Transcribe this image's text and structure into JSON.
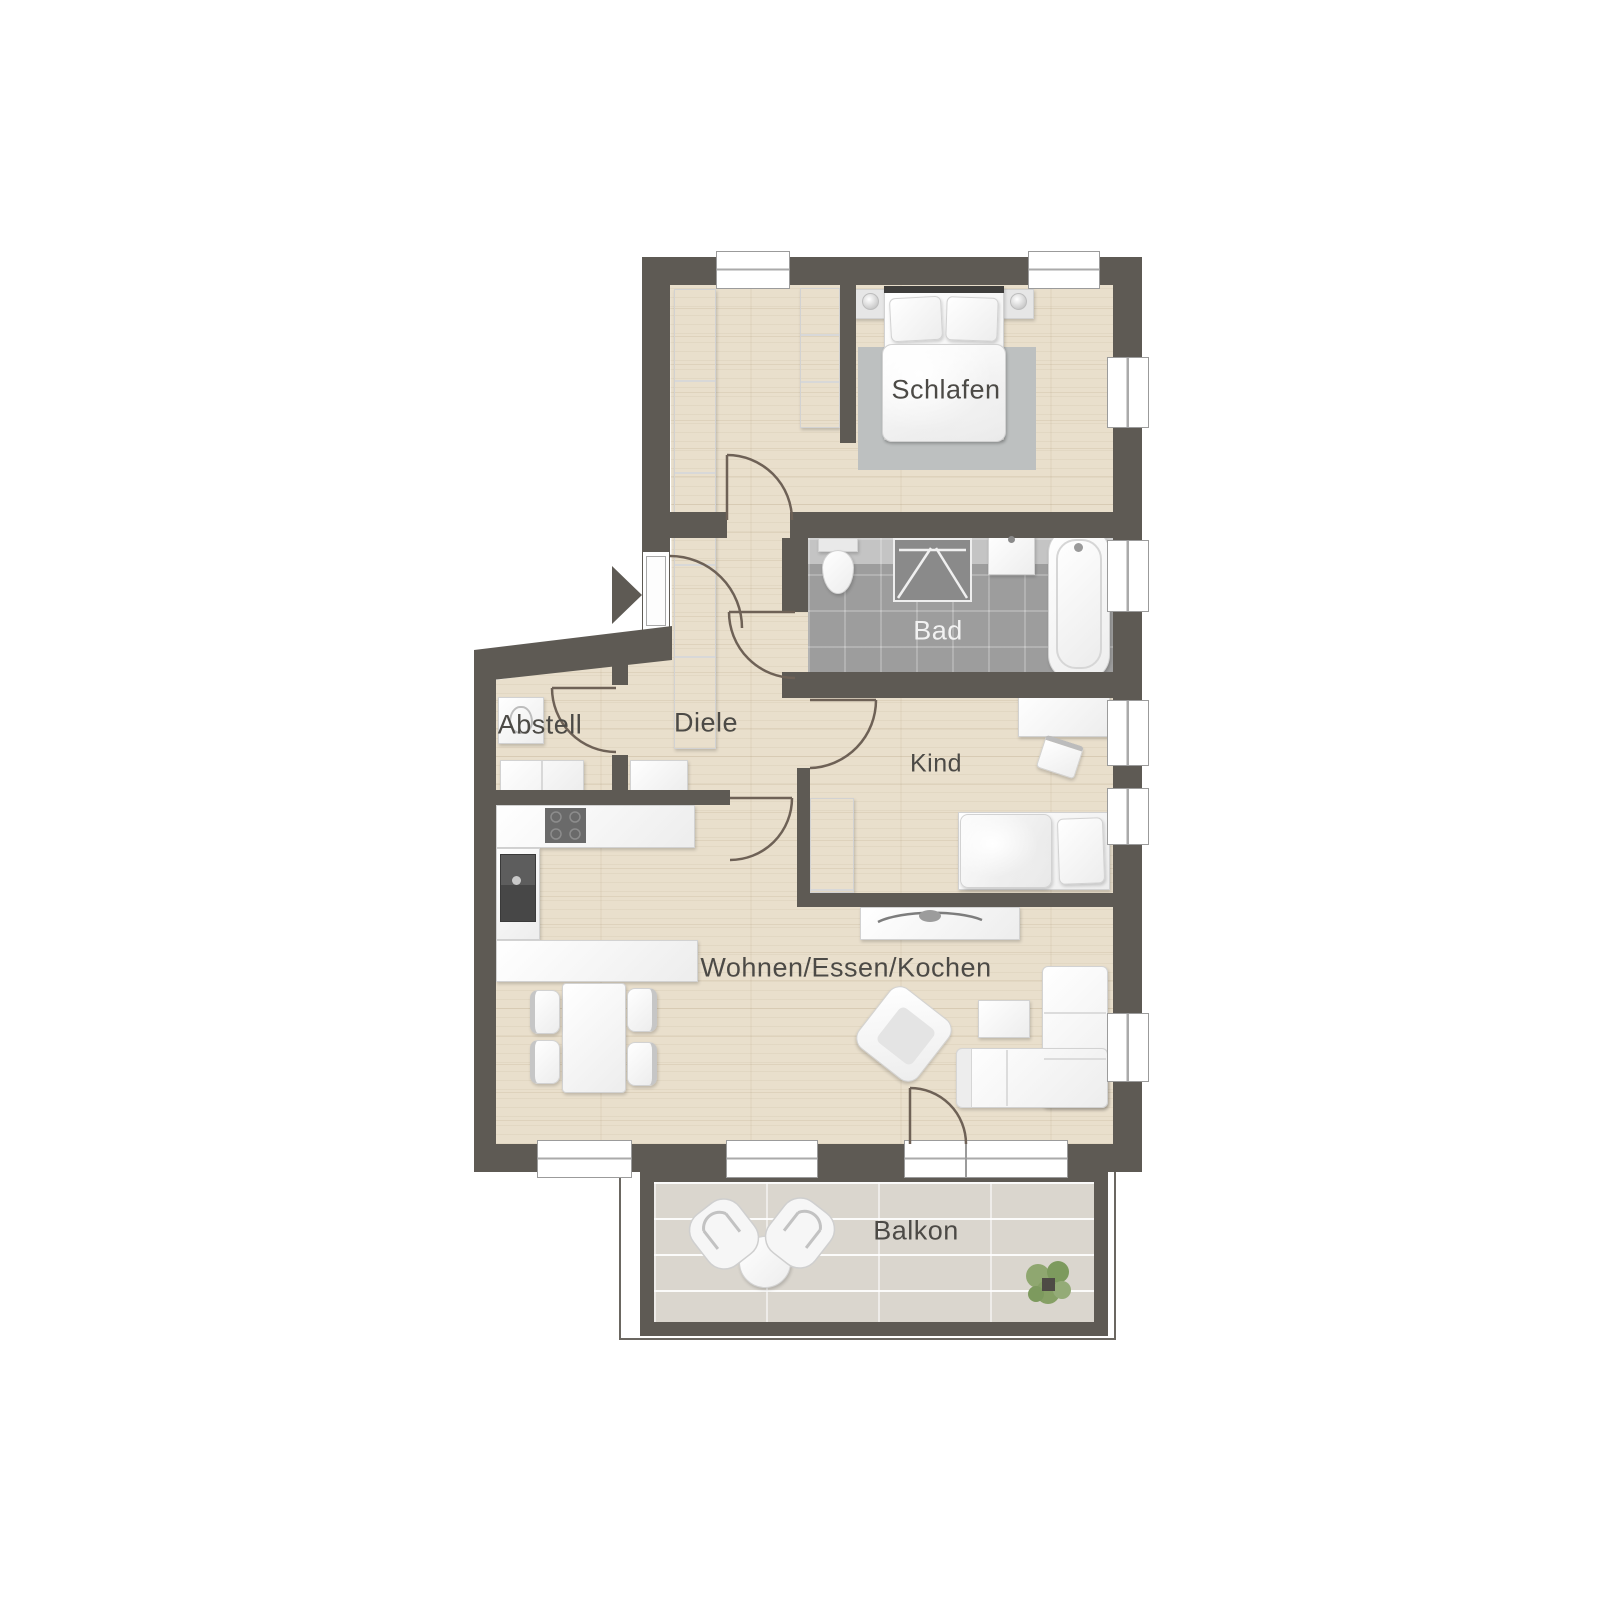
{
  "plan": {
    "background": "#ffffff",
    "colors": {
      "wall": "#5e5a54",
      "wood_floor": "#e9dfcc",
      "bath_floor": "#9d9d9d",
      "balcony_floor": "#dad6ce",
      "rug": "#bdc0c0",
      "furniture": "#fbfbfb",
      "door_arc": "#6e6156",
      "label_text": "#4c4a46",
      "label_text_on_dark": "#f2f2f2",
      "plant_green": "#8fa770"
    },
    "rooms": {
      "schlafen": {
        "label": "Schlafen"
      },
      "bad": {
        "label": "Bad"
      },
      "diele": {
        "label": "Diele"
      },
      "abstell": {
        "label": "Abstell"
      },
      "kind": {
        "label": "Kind"
      },
      "wohnen": {
        "label": "Wohnen/Essen/Kochen"
      },
      "balkon": {
        "label": "Balkon"
      }
    },
    "furniture": {
      "schlafen": [
        "double-bed",
        "pillows",
        "nightstands",
        "bedside-lamps",
        "rug",
        "wardrobes"
      ],
      "bad": [
        "toilet",
        "shower",
        "washbasin",
        "bathtub"
      ],
      "abstell": [
        "washing-machine",
        "cabinets"
      ],
      "kind": [
        "desk",
        "desk-chair",
        "single-bed",
        "wardrobe"
      ],
      "wohnen": [
        "kitchen-counter",
        "cooktop",
        "kitchen-sink",
        "dining-table",
        "dining-chairs",
        "armchair",
        "coffee-table",
        "corner-sofa",
        "sideboard"
      ],
      "balkon": [
        "lounge-chairs",
        "side-table",
        "plant"
      ]
    },
    "entrance_arrow": "entrance-direction-arrow"
  }
}
